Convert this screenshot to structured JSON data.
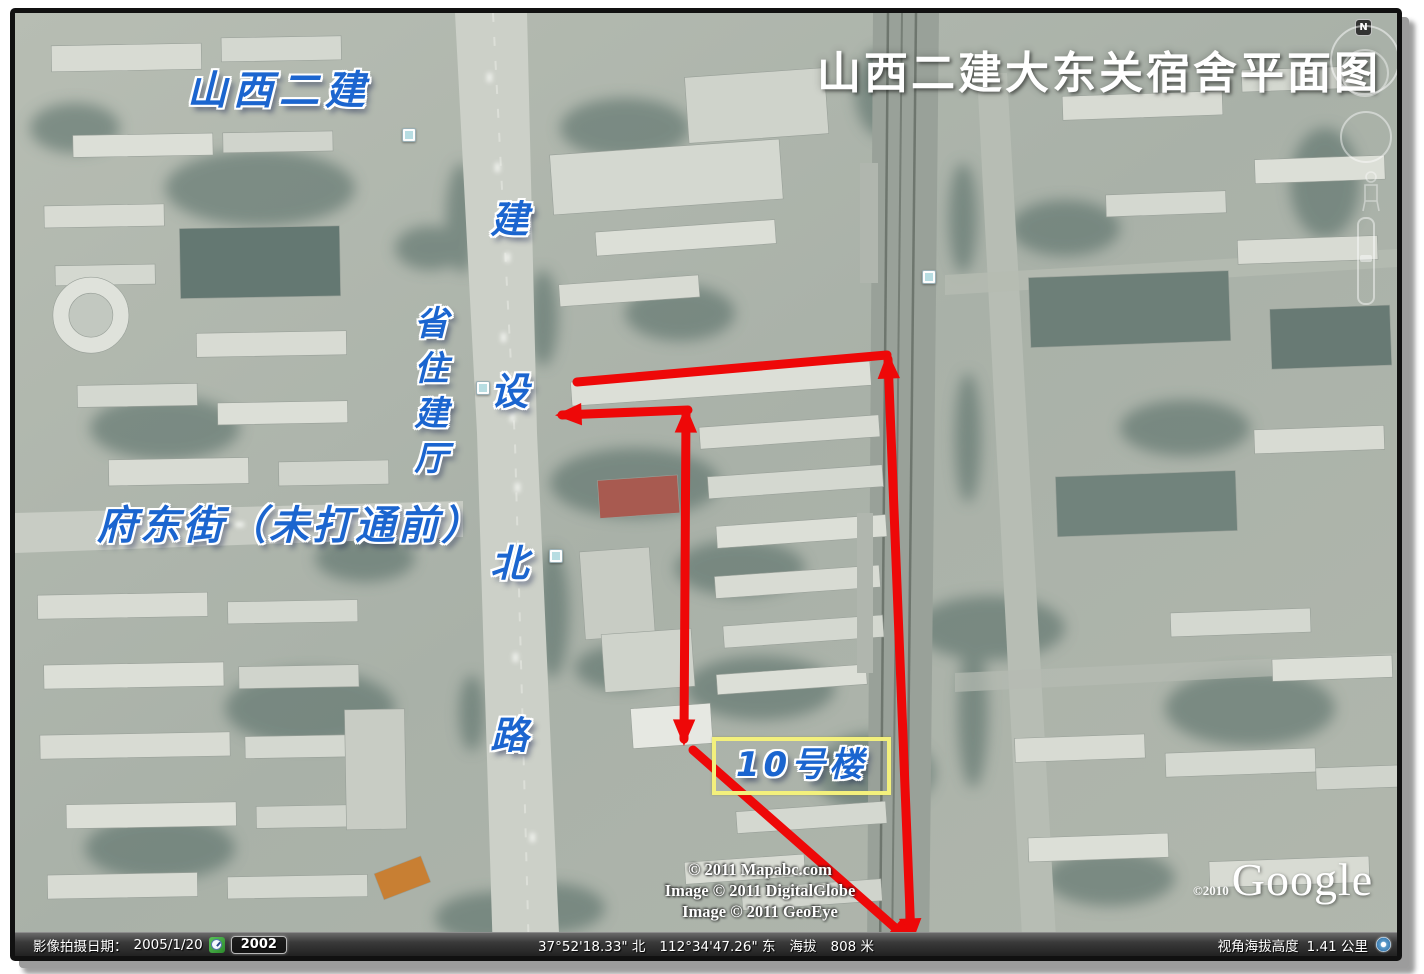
{
  "header": {
    "title": "山西二建大东关宿舍平面图"
  },
  "annotations": {
    "company": "山西二建",
    "road_name_vertical": "建设北路",
    "agency_vertical": "省住建厅",
    "street_label": "府东街（未打通前）",
    "building_label": "10号楼"
  },
  "nav_controls": {
    "north_badge": "N"
  },
  "status_bar": {
    "image_date_label": "影像拍摄日期：",
    "image_date": "2005/1/20",
    "timeline_year": "2002",
    "latitude": "37°52'18.33\" 北",
    "longitude": "112°34'47.26\" 东",
    "elevation_label": "海拔",
    "elevation": "808 米",
    "eye_altitude_label": "视角海拔高度",
    "eye_altitude": "1.41 公里"
  },
  "watermarks": {
    "copyright_line1": "© 2011 Mapabc.com",
    "copyright_line2": "Image © 2011 DigitalGlobe",
    "copyright_line3": "Image © 2011 GeoEye",
    "google_copyright": "©2010",
    "google_logo": "Google"
  },
  "colors": {
    "annotation_red": "#ee0808",
    "label_blue": "#1b65cf",
    "highlight_yellow": "#f3f07c",
    "title_white": "#ffffff"
  }
}
